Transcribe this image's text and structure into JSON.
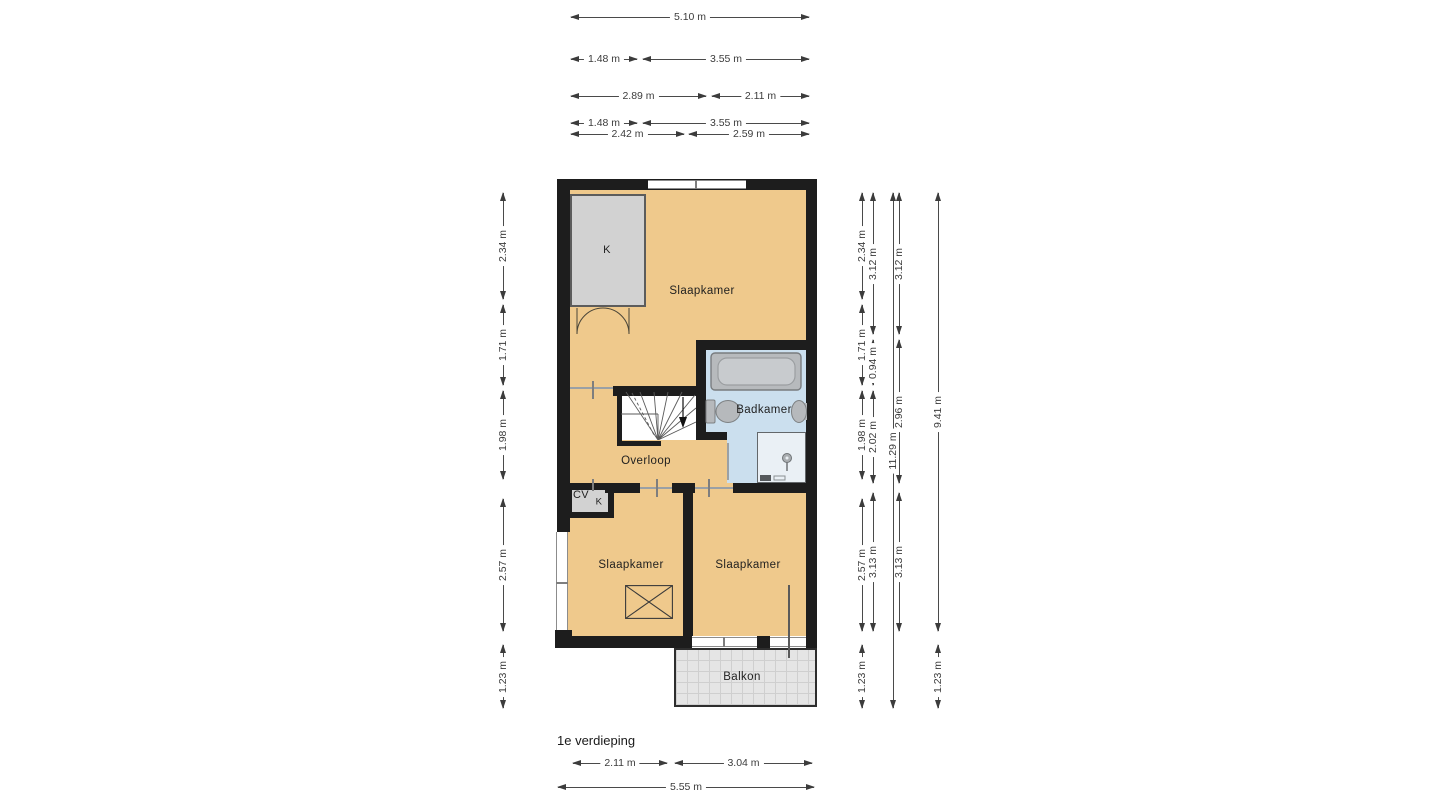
{
  "title": "1e verdieping",
  "colors": {
    "wall": "#1d1d1d",
    "floor": "#efc98c",
    "bathroom_floor": "#cbdfee",
    "closet": "#d2d2d2",
    "balcony": "#e5e5e5",
    "dimtext": "#3c3c3c"
  },
  "rooms": [
    {
      "id": "slaapkamer-top",
      "label": "Slaapkamer",
      "x": 702,
      "y": 291,
      "fs": 11.5
    },
    {
      "id": "slaapkamer-left",
      "label": "Slaapkamer",
      "x": 631,
      "y": 565,
      "fs": 11.5
    },
    {
      "id": "slaapkamer-right",
      "label": "Slaapkamer",
      "x": 748,
      "y": 565,
      "fs": 11.5
    },
    {
      "id": "badkamer",
      "label": "Badkamer",
      "x": 764,
      "y": 410,
      "fs": 11.5
    },
    {
      "id": "overloop",
      "label": "Overloop",
      "x": 646,
      "y": 461,
      "fs": 11.5
    },
    {
      "id": "balkon",
      "label": "Balkon",
      "x": 742,
      "y": 677,
      "fs": 11.5
    },
    {
      "id": "kast",
      "label": "K",
      "x": 607,
      "y": 250,
      "fs": 11
    },
    {
      "id": "cv-kast",
      "label": "CV",
      "x": 581,
      "y": 495,
      "fs": 11
    },
    {
      "id": "kast-klein",
      "label": "K",
      "x": 599,
      "y": 502,
      "fs": 9.5
    }
  ],
  "dimensions": {
    "horizontal": [
      {
        "label": "5.10 m",
        "x": 571,
        "y": 17,
        "w": 238
      },
      {
        "label": "1.48 m",
        "x": 571,
        "y": 59,
        "w": 66
      },
      {
        "label": "3.55 m",
        "x": 643,
        "y": 59,
        "w": 166
      },
      {
        "label": "2.89 m",
        "x": 571,
        "y": 96,
        "w": 135
      },
      {
        "label": "2.11 m",
        "x": 712,
        "y": 96,
        "w": 97
      },
      {
        "label": "1.48 m",
        "x": 571,
        "y": 123,
        "w": 66
      },
      {
        "label": "3.55 m",
        "x": 643,
        "y": 123,
        "w": 166
      },
      {
        "label": "2.42 m",
        "x": 571,
        "y": 134,
        "w": 113
      },
      {
        "label": "2.59 m",
        "x": 689,
        "y": 134,
        "w": 120
      },
      {
        "label": "2.11 m",
        "x": 573,
        "y": 763,
        "w": 94
      },
      {
        "label": "3.04 m",
        "x": 675,
        "y": 763,
        "w": 137
      },
      {
        "label": "5.55 m",
        "x": 558,
        "y": 787,
        "w": 256
      }
    ],
    "vertical": [
      {
        "label": "2.34 m",
        "x": 503,
        "y": 193,
        "h": 106
      },
      {
        "label": "1.71 m",
        "x": 503,
        "y": 305,
        "h": 80
      },
      {
        "label": "1.98 m",
        "x": 503,
        "y": 391,
        "h": 88
      },
      {
        "label": "2.57 m",
        "x": 503,
        "y": 499,
        "h": 132
      },
      {
        "label": "1.23 m",
        "x": 503,
        "y": 645,
        "h": 63
      },
      {
        "label": "2.34 m",
        "x": 862,
        "y": 193,
        "h": 106
      },
      {
        "label": "1.71 m",
        "x": 862,
        "y": 305,
        "h": 80
      },
      {
        "label": "1.98 m",
        "x": 862,
        "y": 391,
        "h": 88
      },
      {
        "label": "2.57 m",
        "x": 862,
        "y": 499,
        "h": 132
      },
      {
        "label": "1.23 m",
        "x": 862,
        "y": 645,
        "h": 63
      },
      {
        "label": "3.12 m",
        "x": 873,
        "y": 193,
        "h": 141
      },
      {
        "label": "0.94 m",
        "x": 873,
        "y": 340,
        "h": 45
      },
      {
        "label": "2.02 m",
        "x": 873,
        "y": 391,
        "h": 92
      },
      {
        "label": "3.13 m",
        "x": 873,
        "y": 493,
        "h": 138
      },
      {
        "label": "11.29 m",
        "x": 893,
        "y": 193,
        "h": 515
      },
      {
        "label": "3.12 m",
        "x": 899,
        "y": 193,
        "h": 141
      },
      {
        "label": "2.96 m",
        "x": 899,
        "y": 340,
        "h": 143
      },
      {
        "label": "3.13 m",
        "x": 899,
        "y": 493,
        "h": 138
      },
      {
        "label": "9.41 m",
        "x": 938,
        "y": 193,
        "h": 438
      },
      {
        "label": "1.23 m",
        "x": 938,
        "y": 645,
        "h": 63
      }
    ]
  }
}
